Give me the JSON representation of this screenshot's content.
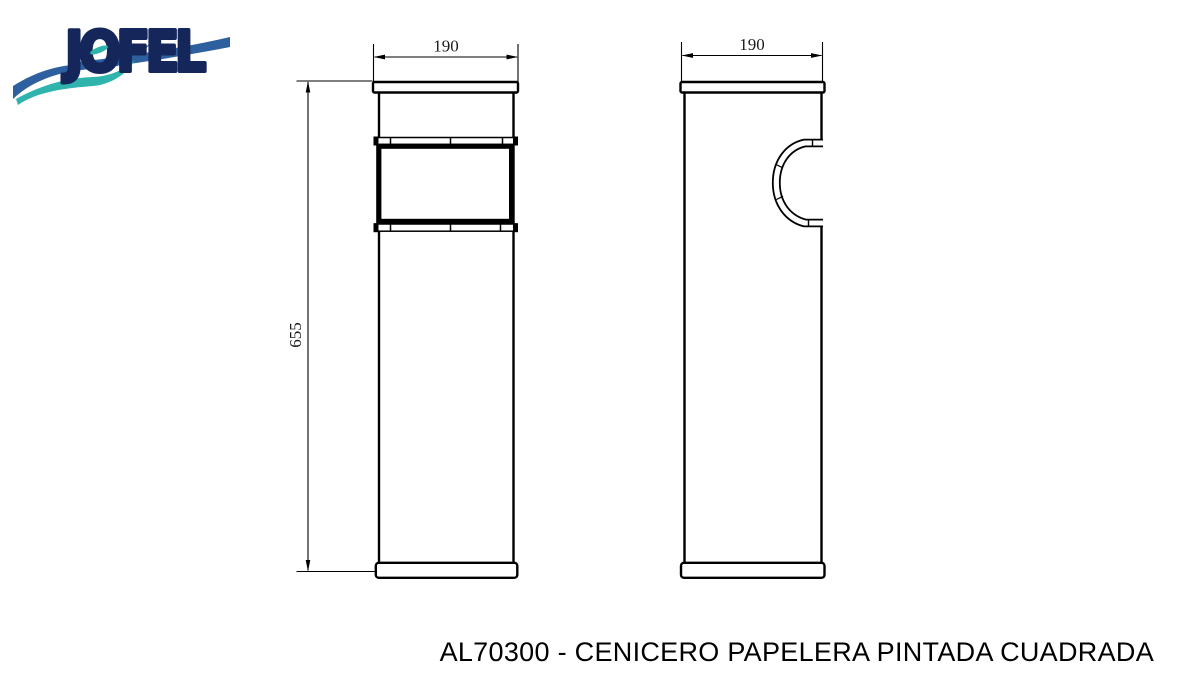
{
  "logo": {
    "brand": "JOFEL",
    "colors": {
      "navy": "#15265b",
      "blue": "#2e5f9e",
      "teal": "#2fb3ad"
    }
  },
  "drawing": {
    "line_color": "#000000",
    "front_view": {
      "name": "front view",
      "width_label": "190",
      "height_label": "655"
    },
    "side_view": {
      "name": "side view",
      "width_label": "190"
    }
  },
  "caption": {
    "text": "AL70300 - CENICERO PAPELERA PINTADA CUADRADA"
  }
}
